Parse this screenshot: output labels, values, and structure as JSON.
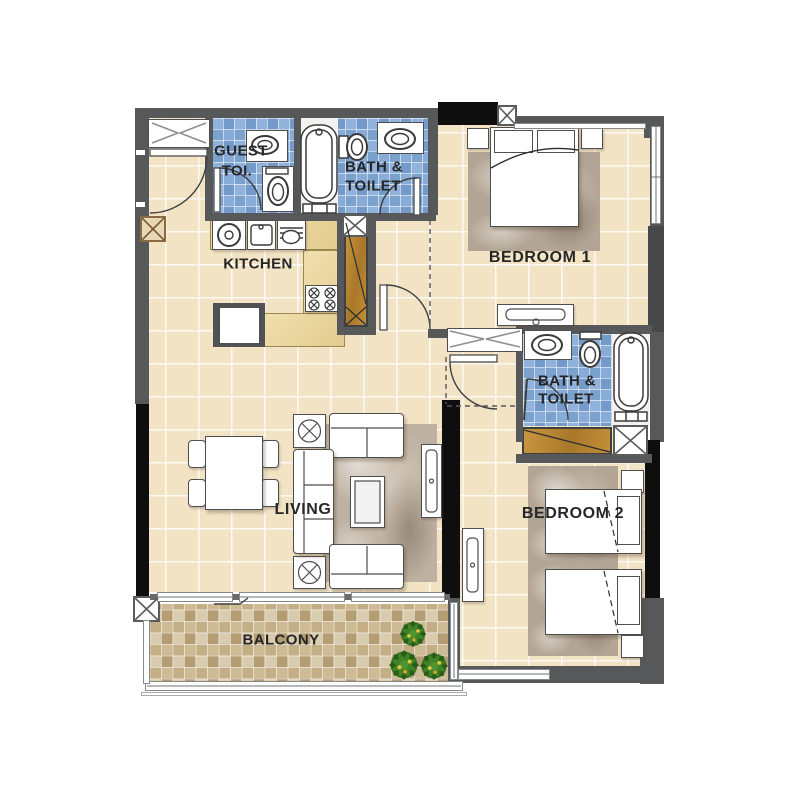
{
  "floorplan": {
    "type": "apartment-floor-plan",
    "rooms": {
      "guest_toilet": {
        "line1": "GUEST",
        "line2": "TOI."
      },
      "bath_toilet_1": {
        "line1": "BATH &",
        "line2": "TOILET"
      },
      "kitchen": {
        "label": "KITCHEN"
      },
      "bedroom_1": {
        "label": "BEDROOM 1"
      },
      "bath_toilet_2": {
        "line1": "BATH &",
        "line2": "TOILET"
      },
      "living": {
        "label": "LIVING"
      },
      "bedroom_2": {
        "label": "BEDROOM 2"
      },
      "balcony": {
        "label": "BALCONY"
      }
    },
    "colors": {
      "wall": "#57585a",
      "structural_wall": "#0e0e0e",
      "floor_tile": "#f2e3c5",
      "bath_tile": "#7fa4d0",
      "balcony_tile_dark": "#b49c73",
      "balcony_tile_light": "#d9cbae",
      "wood_closet": "#b9863c",
      "rug": "#b3a595",
      "label_text": "#262626",
      "background": "#ffffff"
    }
  }
}
